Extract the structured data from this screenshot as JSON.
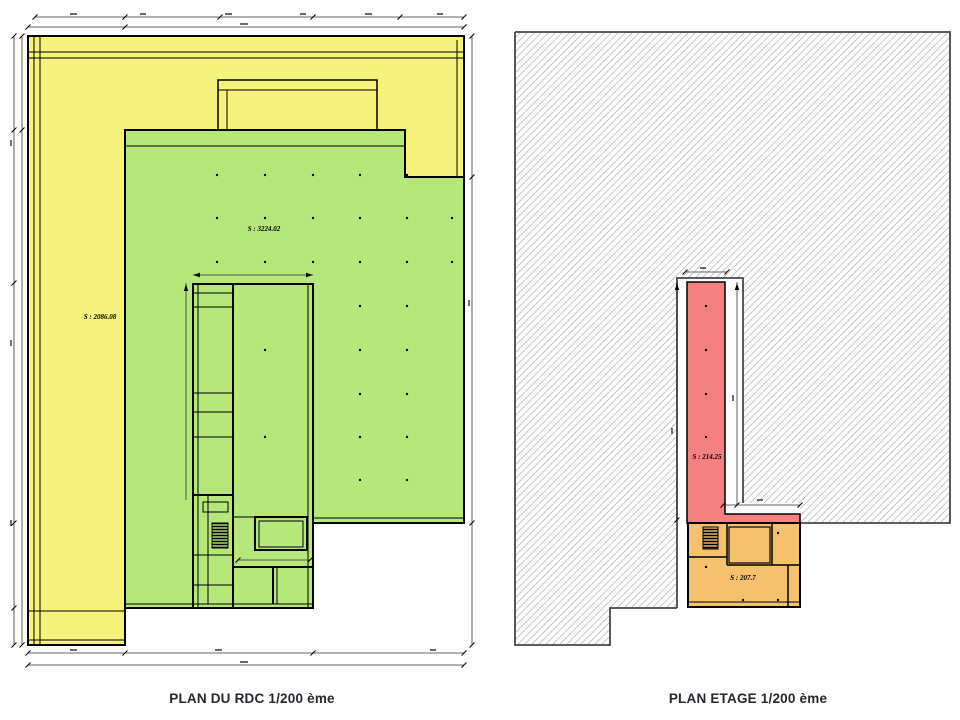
{
  "colors": {
    "yellow": "#f6f37d",
    "green": "#b5e77b",
    "red": "#f48080",
    "orange": "#f5c16f",
    "hatch_line": "#bdbdbd",
    "outline": "#474747",
    "wall": "#000000",
    "dim": "#333333",
    "caption": "#26262e"
  },
  "rdc": {
    "caption": "PLAN DU RDC 1/200 ème",
    "scale": "1/200",
    "area_yellow_label": "S : 2086.08",
    "area_green_label": "S : 3224.02"
  },
  "etage": {
    "caption": "PLAN ETAGE 1/200 ème",
    "scale": "1/200",
    "area_red_label": "S : 214.25",
    "area_orange_label": "S : 207.7"
  }
}
